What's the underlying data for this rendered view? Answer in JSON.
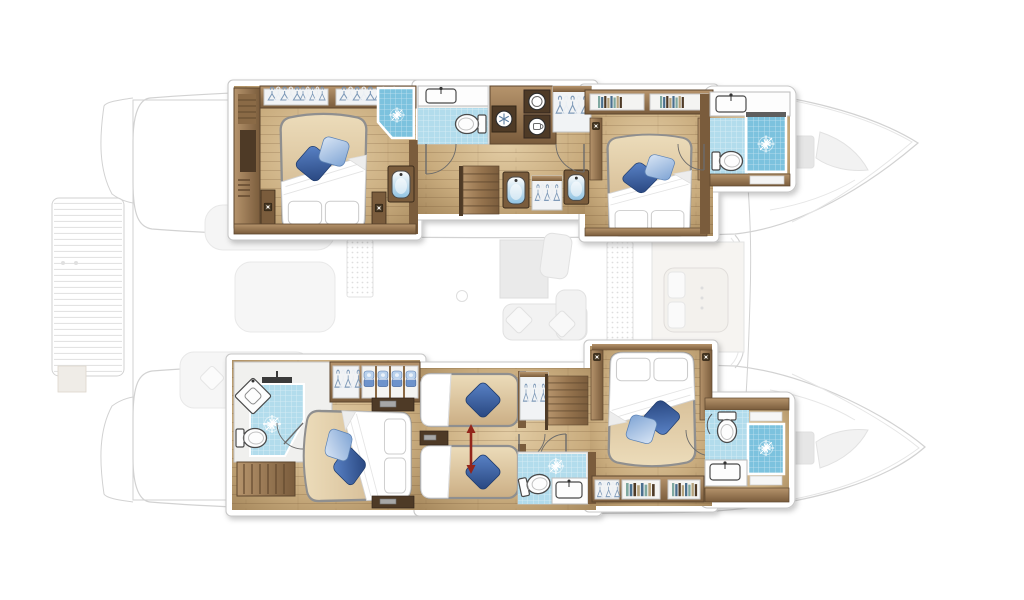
{
  "meta": {
    "title": "Catamaran yacht interior layout – hull accommodation plan"
  },
  "palette": {
    "bg": "#ffffff",
    "ghost-fill": "#f8f8f8",
    "ghost-stroke": "#d2d2d2",
    "ghost-detail": "#e6e6e6",
    "panel": "#ffffff",
    "panel-stroke": "#c7c7c7",
    "floor-light": "#e3cda5",
    "floor-mid": "#c9ac7e",
    "floor-dark": "#a5875c",
    "wood": "#96744e",
    "wood-light": "#b6946c",
    "wood-dark": "#7a5c3c",
    "wood-darker": "#4e3a26",
    "white-fix": "#fdfdfd",
    "fix-stroke": "#4a4a4a",
    "tile": "#b2dcec",
    "tile-deep": "#7cc2de",
    "basin-blue": "#8fc2e2",
    "linen": "#ffffff",
    "linen-shade": "#cccccc",
    "mattress": "#cbae84",
    "mattress-light": "#ecdcba",
    "pillow-dark-1": "#5b84c8",
    "pillow-dark-2": "#27457e",
    "pillow-light-1": "#d8e5f5",
    "pillow-light-2": "#7fa4d4",
    "hanger-blue": "#7f9ab8",
    "hanger-white": "#e9eef4",
    "towel-dark": "#6d93cc",
    "towel-light": "#b9d1ec",
    "book-1": "#7fa8a0",
    "book-2": "#4a6f8e",
    "book-3": "#b5a27c",
    "arrow-red": "#93251a",
    "door-stroke": "#6b6b6b"
  },
  "boat": {
    "type": "sailing-catamaran-floor-plan",
    "hulls": [
      {
        "name": "port-hull",
        "rooms": [
          {
            "name": "aft-owner-cabin",
            "features": [
              "double-bed",
              "blue-deco-pillows",
              "wardrobe-hangers",
              "shower-cubicle",
              "washbasin-unit",
              "nightstand-lamps"
            ]
          },
          {
            "name": "mid-bathroom",
            "features": [
              "vanity-sink",
              "toilet",
              "door"
            ]
          },
          {
            "name": "companionway",
            "features": [
              "stairs-down",
              "freezer",
              "washer",
              "dryer",
              "hanging-locker",
              "two-washbasin-units"
            ]
          },
          {
            "name": "forward-cabin",
            "features": [
              "double-bed",
              "blue-deco-pillows",
              "bookshelf",
              "reading-lamps"
            ]
          },
          {
            "name": "forward-bathroom",
            "features": [
              "vanity-sink",
              "toilet",
              "shower-cubicle"
            ]
          }
        ]
      },
      {
        "name": "starboard-hull",
        "rooms": [
          {
            "name": "aft-cabin",
            "features": [
              "double-bed",
              "blue-deco-pillows",
              "corner-shower-bathroom",
              "vanity-sink",
              "toilet",
              "hanging-locker",
              "towel-cubbies",
              "teak-bench"
            ]
          },
          {
            "name": "convertible-twin-cabin",
            "features": [
              "single-bed",
              "single-bed",
              "slide-together-arrow",
              "hanging-locker",
              "storage-drawer"
            ]
          },
          {
            "name": "companionway",
            "features": [
              "stairs-down",
              "doors"
            ]
          },
          {
            "name": "mid-bathroom",
            "features": [
              "toilet",
              "vanity-sink",
              "shower-floor"
            ]
          },
          {
            "name": "forward-cabin",
            "features": [
              "double-bed",
              "blue-deco-pillows",
              "bookshelf",
              "hanging-locker",
              "reading-lamps"
            ]
          },
          {
            "name": "forward-bathroom",
            "features": [
              "toilet",
              "vanity-sink",
              "shower-cubicle"
            ]
          }
        ]
      }
    ],
    "ghost_deck": [
      "swim-platform-slats",
      "stern-steps",
      "cockpit-lounge",
      "saloon-sofa",
      "saloon-table",
      "drink-holder",
      "deck-hatch-grids",
      "forward-cabin-below",
      "bow-trampoline-hatches",
      "bow-sail-locker"
    ]
  }
}
